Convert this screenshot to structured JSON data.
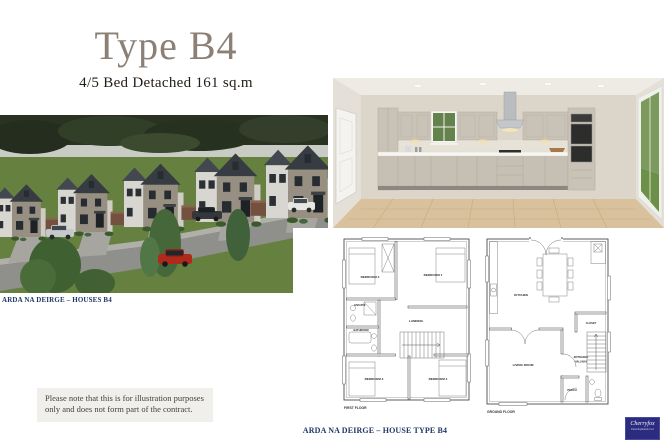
{
  "header": {
    "title": "Type B4",
    "subtitle": "4/5 Bed Detached 161 sq.m"
  },
  "houses_render": {
    "caption": "ARDA NA DEIRGE – HOUSES B4"
  },
  "floor_plans": {
    "first_floor": {
      "caption": "FIRST FLOOR",
      "rooms": {
        "bedroom2": "BEDROOM 2",
        "bedroom1": "BEDROOM 1",
        "ensuite": "ENSUITE",
        "bathroom": "BATHROOM",
        "landing": "LANDING",
        "bedroom3": "BEDROOM 3",
        "bedroom4": "BEDROOM 4"
      }
    },
    "ground_floor": {
      "caption": "GROUND FLOOR",
      "rooms": {
        "kitchen": "KITCHEN",
        "closet": "CLOSET",
        "living_room": "LIVING ROOM",
        "entrance_line1": "ENTRANCE",
        "entrance_line2": "HALLWAY",
        "porch": "PORCH"
      }
    }
  },
  "disclaimer": {
    "line1": "Please note that this is for illustration purposes",
    "line2": "only and does not form part of the contract."
  },
  "footer": {
    "caption": "ARDA NA DEIRGE – HOUSE TYPE B4"
  },
  "logo": {
    "name": "Cherryfox",
    "tagline": "Developments Ltd"
  },
  "colors": {
    "title": "#8c8076",
    "caption_navy": "#1f3864",
    "note_bg": "#f1efec",
    "logo_bg": "#2b2b80"
  }
}
